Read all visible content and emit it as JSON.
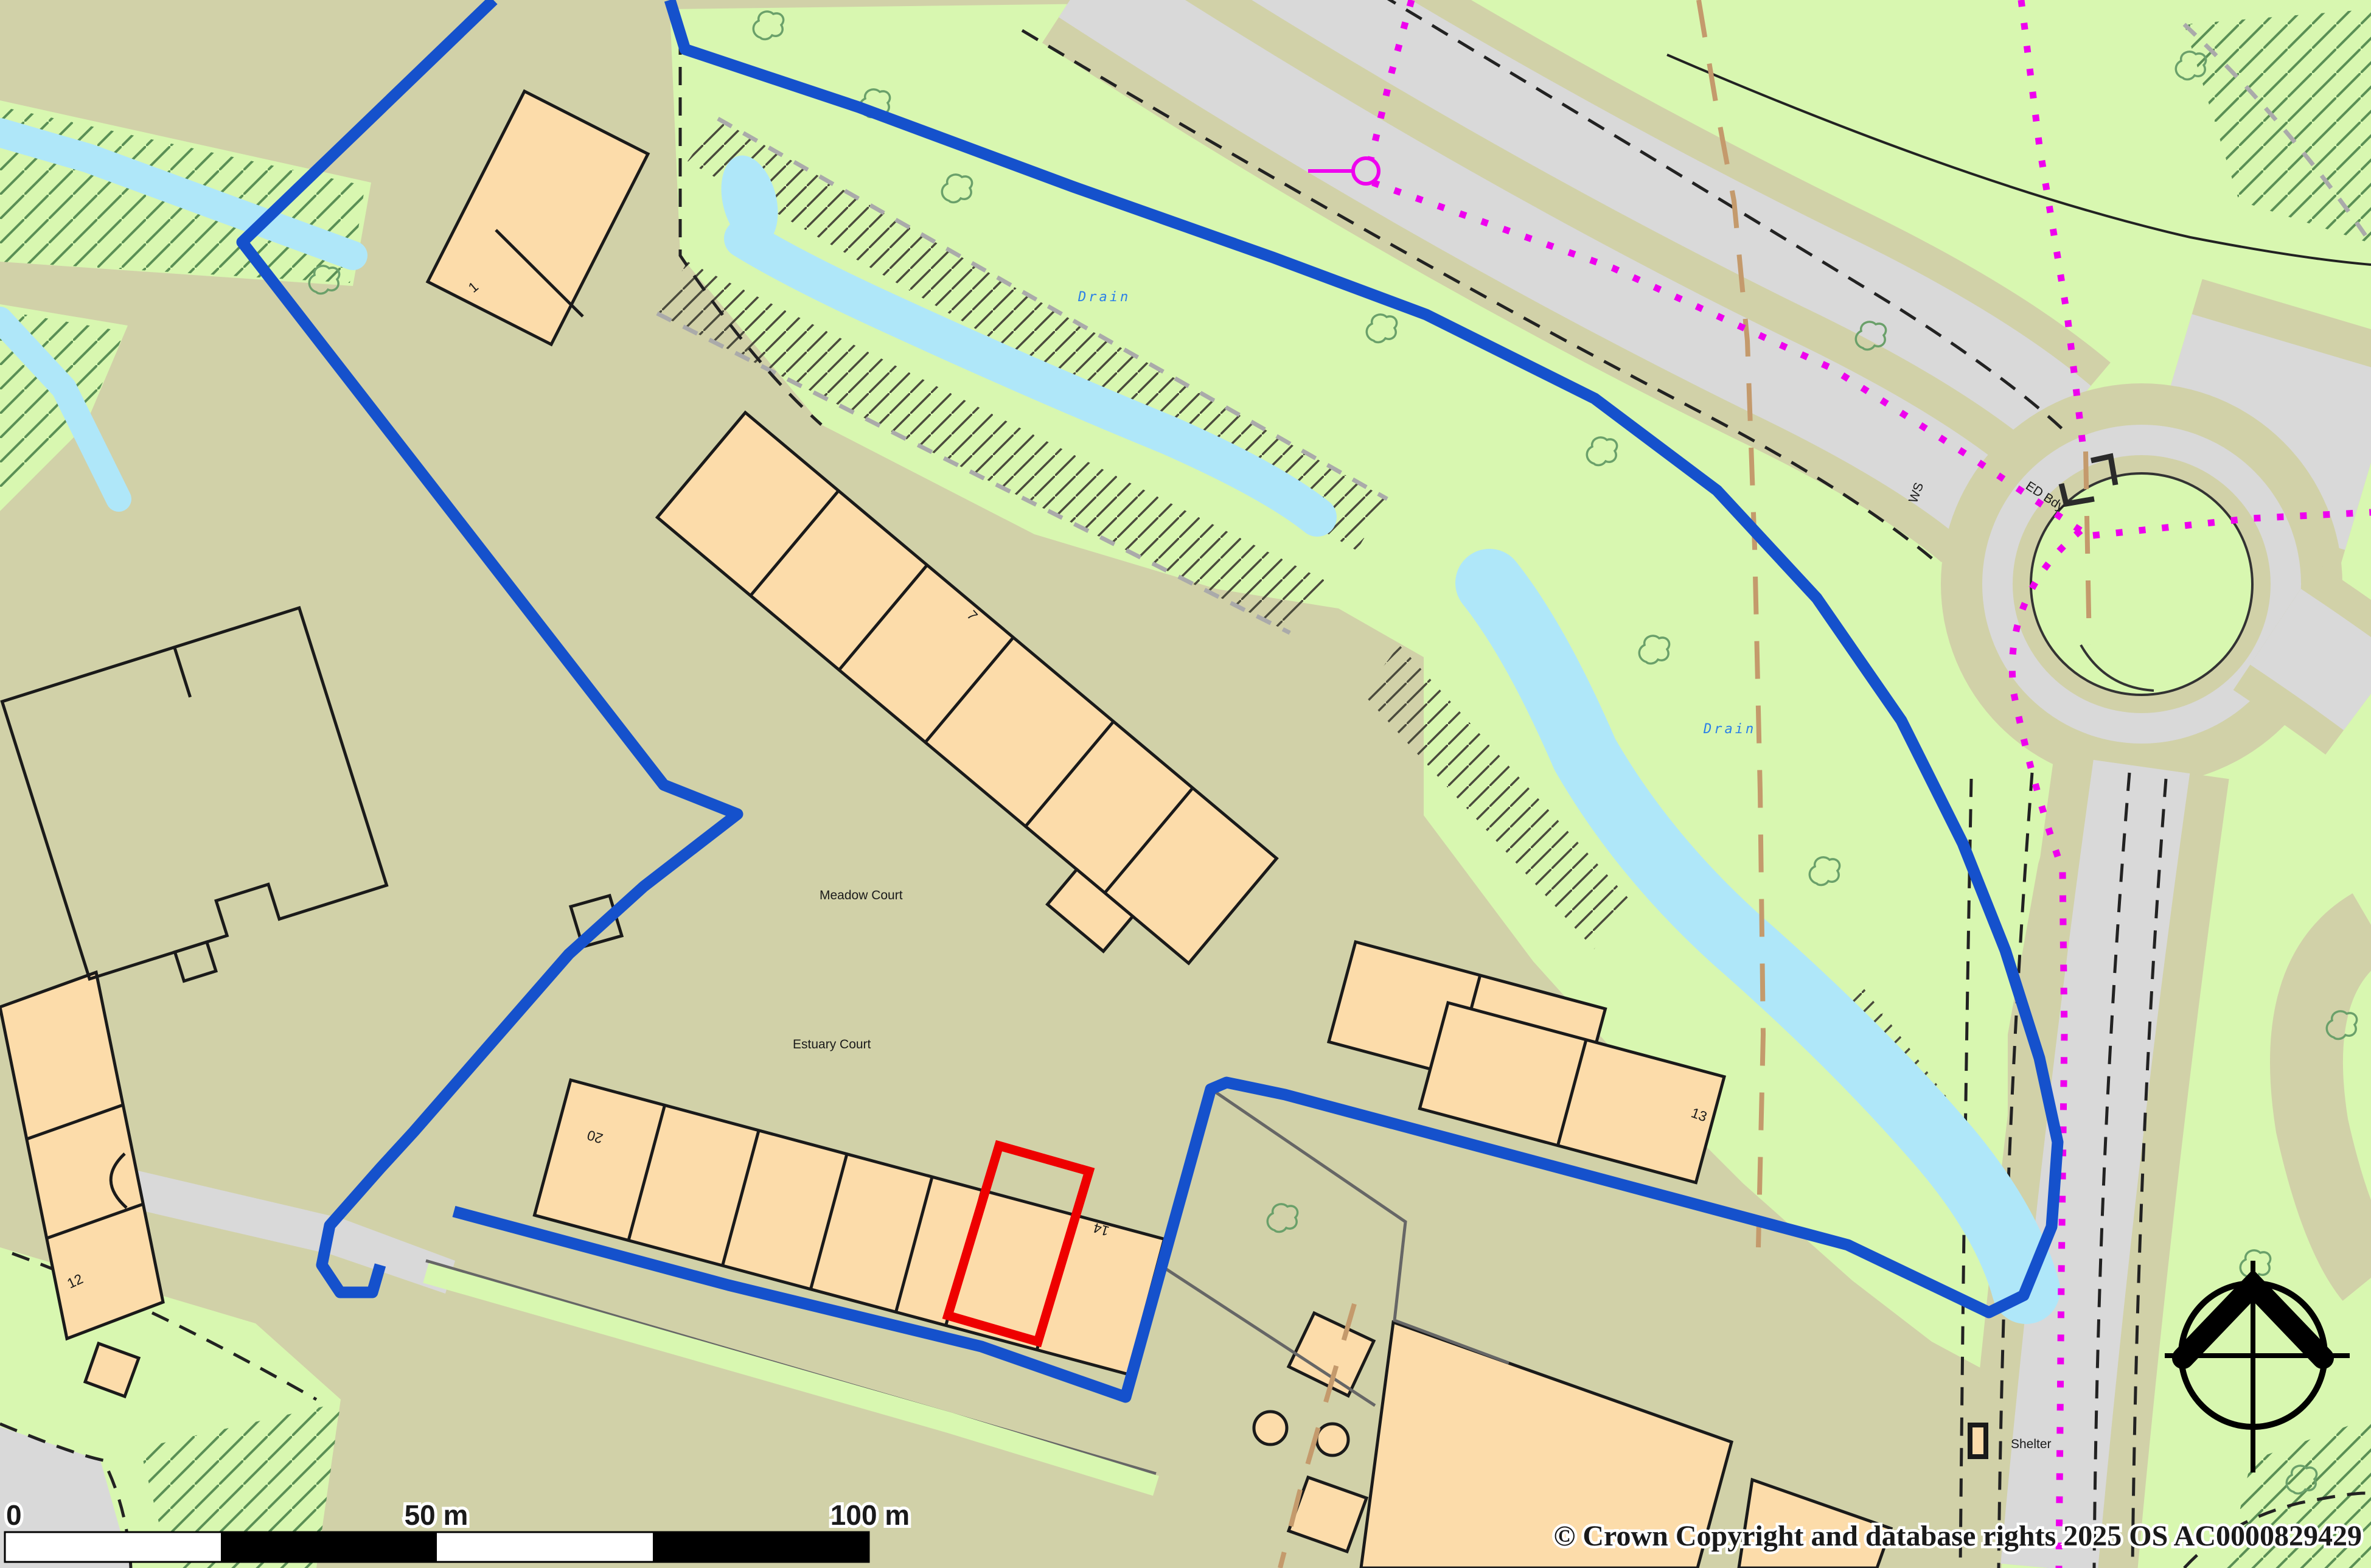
{
  "map": {
    "place_labels": {
      "meadow_court": "Meadow Court",
      "estuary_court": "Estuary Court",
      "drain_upper": "Drain",
      "drain_lower": "Drain",
      "ed_boundary": "ED Bdy",
      "ws": "WS",
      "shelter": "Shelter"
    },
    "building_numbers": {
      "unit_1": "1",
      "unit_7": "7",
      "unit_12": "12",
      "unit_13": "13",
      "unit_14": "14",
      "unit_20": "20"
    },
    "scale_bar": {
      "start_label": "0",
      "mid_label": "50 m",
      "end_label": "100 m"
    },
    "attribution": "© Crown Copyright and database rights 2025 OS AC0000829429",
    "colors": {
      "site_boundary_blue": "#1551cc",
      "selection_red": "#ee0000",
      "building_fill": "#fcdcaa",
      "land_khaki": "#d1d1a8",
      "grass_green": "#d8f7b0",
      "road_gray": "#d9d9d9",
      "water_blue": "#afe7f9",
      "ed_boundary_magenta": "#ee00ee",
      "parish_dash_brown": "#c49a6c"
    }
  }
}
